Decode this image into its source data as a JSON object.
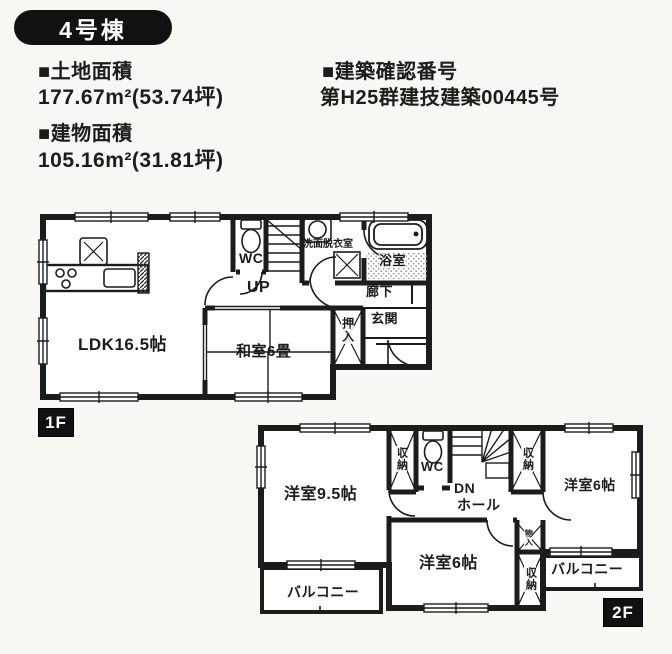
{
  "colors": {
    "ink": "#1c1c1c",
    "badge_bg": "#111111",
    "badge_text": "#ffffff",
    "paper": "#f8f7f4"
  },
  "header": {
    "badge": "4号棟",
    "land": {
      "label": "■土地面積",
      "value": "177.67m²(53.74坪)"
    },
    "confirm": {
      "label": "■建築確認番号",
      "value": "第H25群建技建築00445号"
    },
    "building": {
      "label": "■建物面積",
      "value": "105.16m²(31.81坪)"
    }
  },
  "f1": {
    "badge": "1F",
    "ldk": "LDK16.5帖",
    "washitsu": "和室6畳",
    "oshiire": "押入",
    "wc": "WC",
    "up": "UP",
    "senmen": "洗面脱衣室",
    "bath": "浴室",
    "rouka": "廊下",
    "genkan": "玄関"
  },
  "f2": {
    "badge": "2F",
    "west95": "洋室9.5帖",
    "west6_right": "洋室6帖",
    "west6_bottom": "洋室6帖",
    "wc": "WC",
    "dn": "DN",
    "hall": "ホール",
    "storage_left": "収納",
    "storage_right": "収納",
    "storage_bottom": "収納",
    "monoire": "物入",
    "balcony_left": "バルコニー",
    "balcony_right": "バルコニー"
  }
}
